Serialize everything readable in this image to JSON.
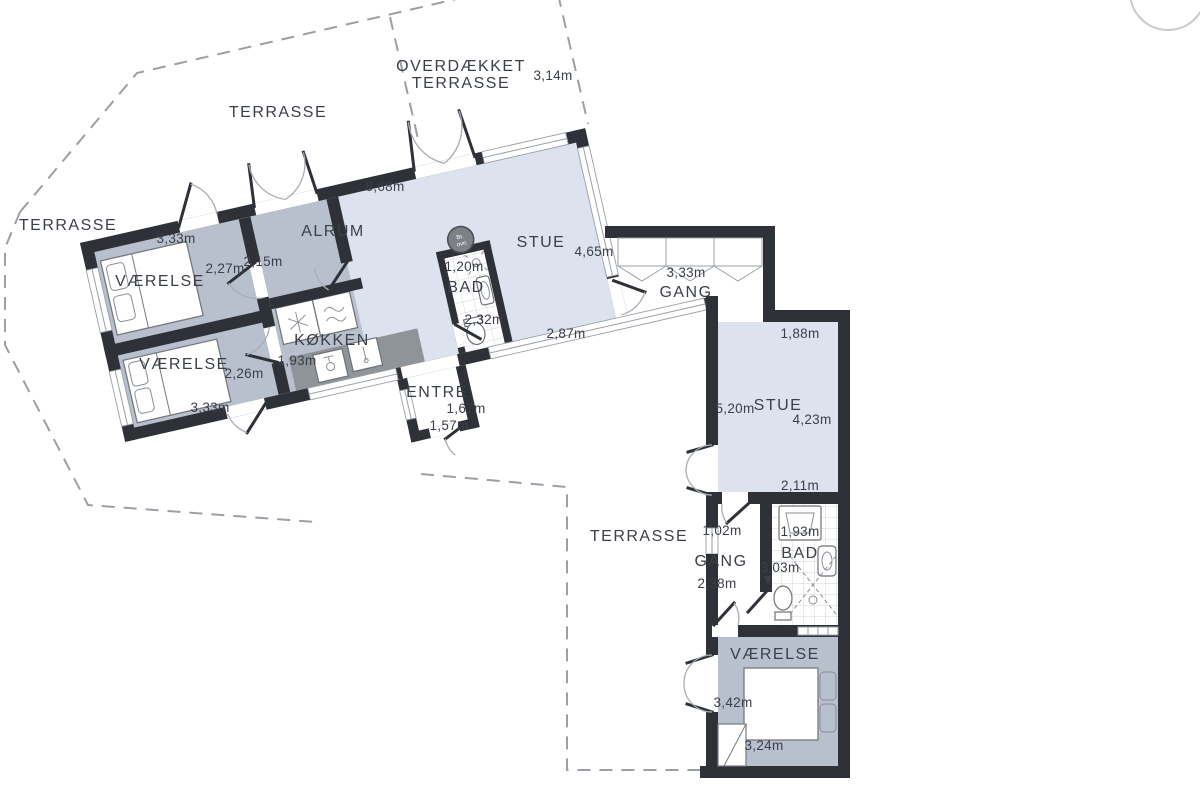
{
  "colors": {
    "wall": "#2e3138",
    "room-light": "#dce2ee",
    "room-dark": "#b8c0cd",
    "counter": "#8f9499",
    "dash": "#9aa0a6",
    "winframe": "#9aa0a6",
    "tile": "#d3d6da",
    "text": "#3b3f48"
  },
  "labels": {
    "terrasse_top": "TERRASSE",
    "terrasse_left": "TERRASSE",
    "terrasse_bottom": "TERRASSE",
    "overdaekket_line1": "OVERDÆKKET",
    "overdaekket_line2": "TERRASSE",
    "alrum": "ALRUM",
    "stue_left": "STUE",
    "stue_right": "STUE",
    "koekken": "KØKKEN",
    "bad_left": "BAD",
    "bad_right": "BAD",
    "gang_top": "GANG",
    "gang_right": "GANG",
    "vaerelse_1": "VÆRELSE",
    "vaerelse_2": "VÆRELSE",
    "vaerelse_3": "VÆRELSE",
    "entre": "ENTRÉ",
    "stove_line1": "Br.",
    "stove_line2": "ovn"
  },
  "measurements": {
    "m_3_14": "3,14m",
    "m_8_68": "8,68m",
    "m_3_33_bed1": "3,33m",
    "m_2_27": "2,27m",
    "m_2_15": "2,15m",
    "m_2_26": "2,26m",
    "m_3_33_bed2": "3,33m",
    "m_1_93_koekken": "1,93m",
    "m_1_20": "1,20m",
    "m_2_32": "2,32m",
    "m_4_65": "4,65m",
    "m_2_87": "2,87m",
    "m_1_67": "1,67m",
    "m_1_57": "1,57m",
    "m_3_33_gang": "3,33m",
    "m_1_88": "1,88m",
    "m_5_20": "5,20m",
    "m_4_23": "4,23m",
    "m_2_11": "2,11m",
    "m_1_02": "1,02m",
    "m_2_38": "2,38m",
    "m_1_93_bad": "1,93m",
    "m_3_03": "3,03m",
    "m_3_42": "3,42m",
    "m_3_24": "3,24m"
  }
}
